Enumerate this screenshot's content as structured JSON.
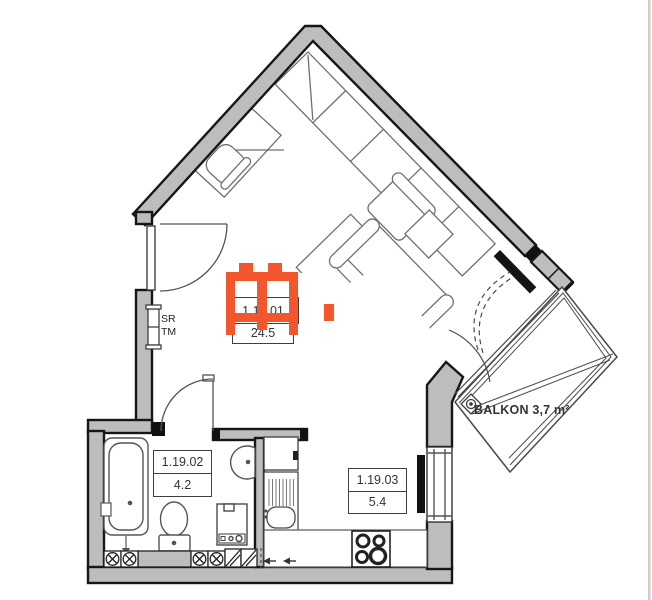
{
  "plan": {
    "rooms": [
      {
        "number": "1.19.01",
        "area": "24.5"
      },
      {
        "number": "1.19.02",
        "area": "4.2"
      },
      {
        "number": "1.19.03",
        "area": "5.4"
      }
    ],
    "balcony_label": "BALKON 3,7 m²",
    "wall_tags": {
      "line1": "SR",
      "line2": "TM"
    },
    "colors": {
      "wall_fill": "#bdbdbd",
      "wall_outline": "#161616",
      "furniture_line": "#6f6f6f",
      "watermark_orange": "#f3562c"
    }
  }
}
